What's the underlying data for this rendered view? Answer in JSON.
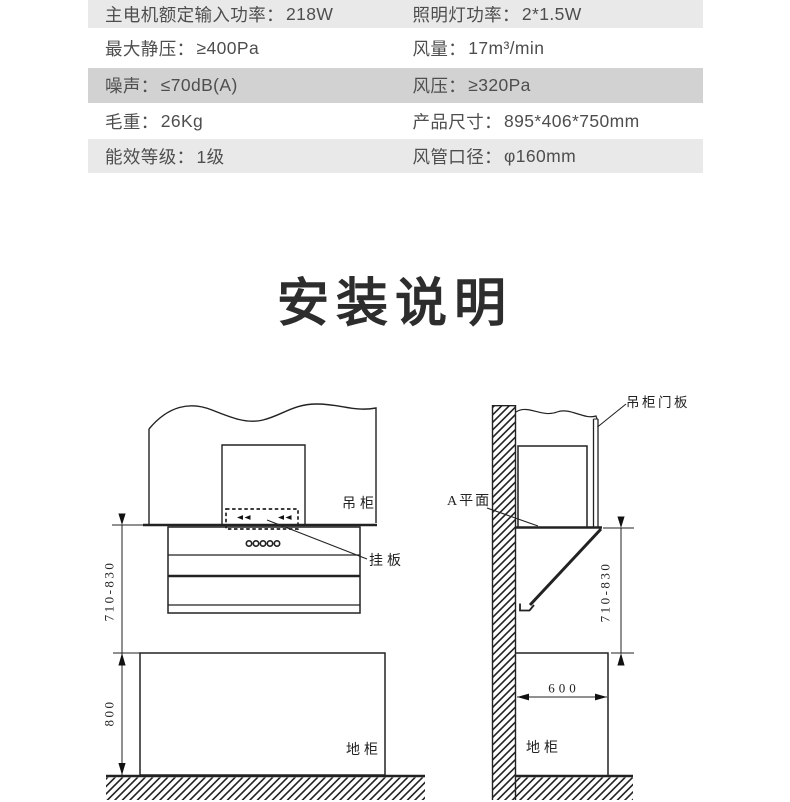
{
  "page": {
    "background": "#ffffff"
  },
  "spec_table": {
    "text_color": "#4e4e4e",
    "rows": [
      {
        "left_label": "主电机额定输入功率：",
        "left_value": "218W",
        "right_label": "照明灯功率：",
        "right_value": "2*1.5W",
        "bg": "#e9e9e9"
      },
      {
        "left_label": "最大静压：",
        "left_value": "≥400Pa",
        "right_label": "风量：",
        "right_value": "17m³/min",
        "bg": "#ffffff"
      },
      {
        "left_label": "噪声：",
        "left_value": "≤70dB(A)",
        "right_label": "风压：",
        "right_value": "≥320Pa",
        "bg": "#d2d2d2"
      },
      {
        "left_label": "毛重：",
        "left_value": "26Kg",
        "right_label": "产品尺寸：",
        "right_value": "895*406*750mm",
        "bg": "#ffffff"
      },
      {
        "left_label": "能效等级：",
        "left_value": "1级",
        "right_label": "风管口径：",
        "right_value": "φ160mm",
        "bg": "#e9e9e9"
      }
    ]
  },
  "title": {
    "text": "安装说明",
    "color": "#2d2d2d"
  },
  "diagram": {
    "line_color": "#222222",
    "left": {
      "cabinet_label": "吊柜",
      "plate_label": "挂板",
      "floor_cabinet_label": "地柜",
      "height_range_label": "710-830",
      "floor_height_label": "800"
    },
    "right": {
      "door_panel_label": "吊柜门板",
      "a_plane_label": "A平面",
      "height_range_label": "710-830",
      "depth_label": "600",
      "floor_cabinet_label": "地柜"
    }
  }
}
